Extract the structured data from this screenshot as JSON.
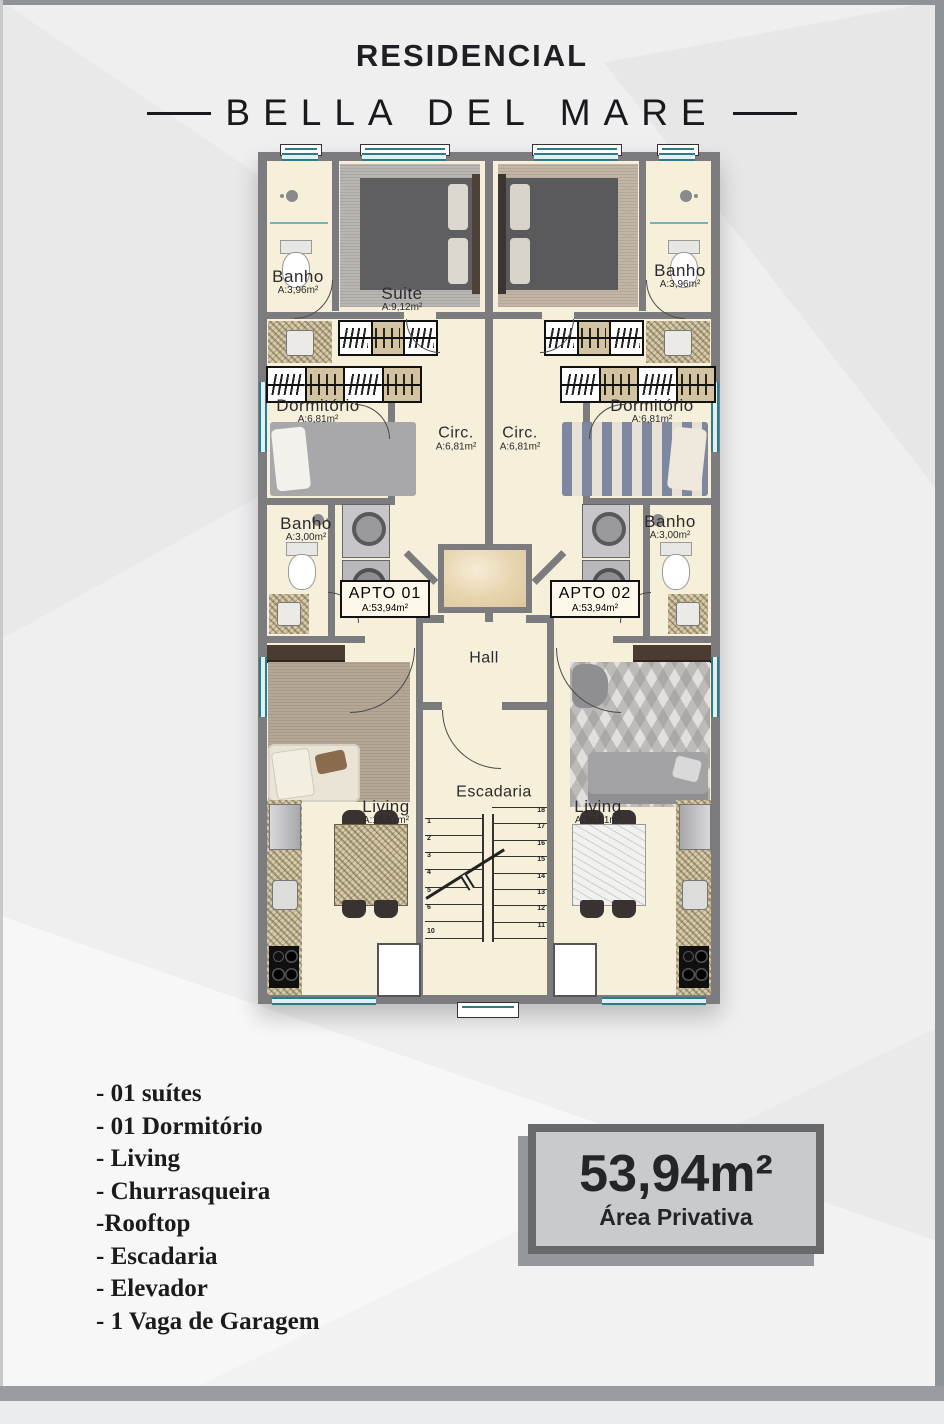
{
  "header": {
    "line1": "RESIDENCIAL",
    "line2": "BELLA DEL MARE"
  },
  "plan": {
    "rooms": {
      "banho_tl": {
        "name": "Banho",
        "area": "A:3,96m²"
      },
      "suite_l": {
        "name": "Suite",
        "area": "A:9,12m²"
      },
      "banho_tr": {
        "name": "Banho",
        "area": "A:3,96m²"
      },
      "dormitorio_l": {
        "name": "Dormitório",
        "area": "A:6,81m²"
      },
      "circ_l": {
        "name": "Circ.",
        "area": "A:6,81m²"
      },
      "circ_r": {
        "name": "Circ.",
        "area": "A:6,81m²"
      },
      "dormitorio_r": {
        "name": "Dormitório",
        "area": "A:6,81m²"
      },
      "banho_ml": {
        "name": "Banho",
        "area": "A:3,00m²"
      },
      "banho_mr": {
        "name": "Banho",
        "area": "A:3,00m²"
      },
      "apto1": {
        "name": "APTO 01",
        "area": "A:53,94m²"
      },
      "apto2": {
        "name": "APTO 02",
        "area": "A:53,94m²"
      },
      "hall": {
        "name": "Hall"
      },
      "living_l": {
        "name": "Living",
        "area": "A:16,51m²"
      },
      "escadaria": {
        "name": "Escadaria"
      },
      "living_r": {
        "name": "Living",
        "area": "A:16,51m²"
      }
    },
    "stairs": {
      "left": [
        "1",
        "2",
        "3",
        "4",
        "5",
        "6",
        "10"
      ],
      "right": [
        "18",
        "17",
        "16",
        "15",
        "14",
        "13",
        "12",
        "11"
      ]
    }
  },
  "features": {
    "items": [
      "- 01 suítes",
      "- 01 Dormitório",
      "- Living",
      "- Churrasqueira",
      "-Rooftop",
      "- Escadaria",
      "- Elevador",
      "- 1 Vaga de Garagem"
    ]
  },
  "badge": {
    "area": "53,94m²",
    "label": "Área Privativa"
  },
  "colors": {
    "wall": "#7c7c7e",
    "floor": "#f6efda",
    "window_teal": "#2c7b89",
    "badge_bg": "#c8cacd",
    "badge_border": "#68696b",
    "text": "#1b1b1d"
  }
}
